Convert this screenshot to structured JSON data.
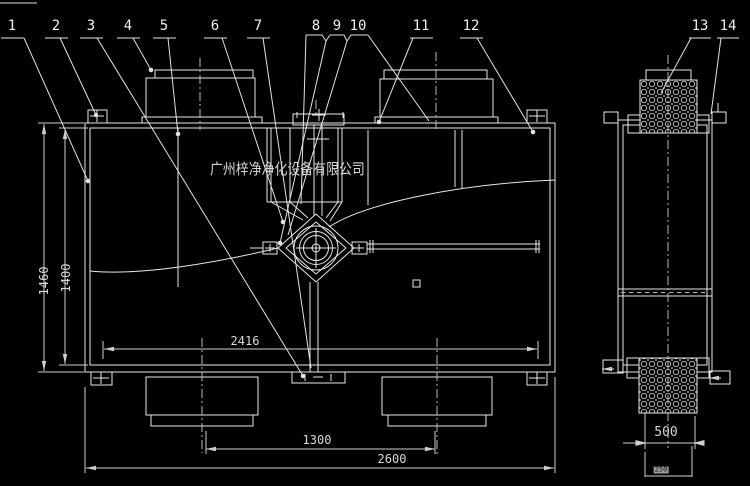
{
  "watermark": "广州梓净净化设备有限公司",
  "callouts": [
    "1",
    "2",
    "3",
    "4",
    "5",
    "6",
    "7",
    "8",
    "9",
    "10",
    "11",
    "12",
    "13",
    "14"
  ],
  "dimensions": {
    "height_outer": "1460",
    "height_inner": "1400",
    "inner_width": "2416",
    "outlet_spacing": "1300",
    "overall_width": "2600",
    "side_width": "500",
    "side_port": "250"
  },
  "colors": {
    "background": "#000000",
    "object_line": "#e8e8e8",
    "dimension_line": "#cfcfcf",
    "dimension_text": "#d8d8d8",
    "watermark_text": "#d6d6d6",
    "selection_highlight": "#9a9a9a"
  }
}
